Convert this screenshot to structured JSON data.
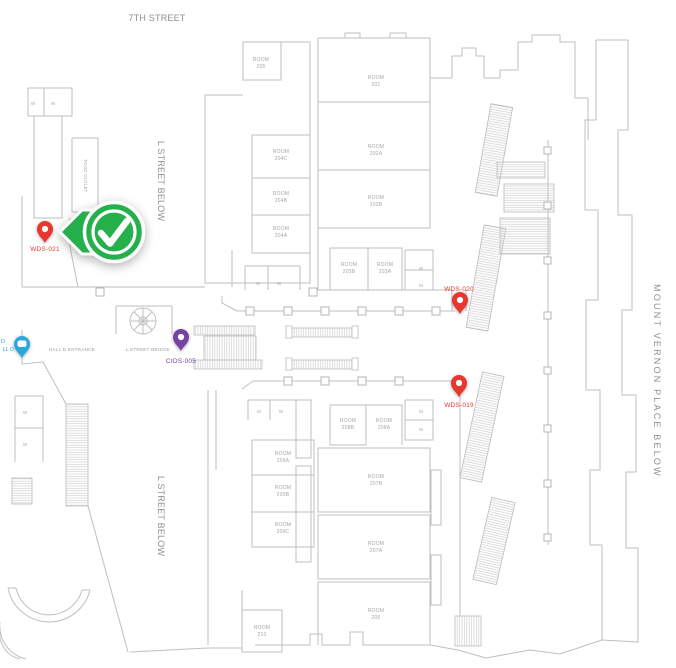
{
  "map": {
    "colors": {
      "red": "#e8372e",
      "purple": "#7544a3",
      "cyan": "#29a8e0",
      "green": "#25b04b",
      "wall": "#bfbfbf"
    },
    "streets": {
      "seventh": "7TH STREET",
      "l_street_upper": "L STREET BELOW",
      "l_street_lower": "L STREET BELOW",
      "mount_vernon": "MOUNT VERNON PLACE BELOW"
    },
    "areas": {
      "hall_d_entrance": "HALL D ENTRANCE",
      "l_street_bridge": "L STREET BRIDGE",
      "food_outlet": "FOOD OUTLET"
    },
    "legend": {
      "w": "W",
      "m": "M"
    },
    "room_word": "ROOM",
    "rooms": [
      {
        "number": "205"
      },
      {
        "number": "201"
      },
      {
        "number": "204C"
      },
      {
        "number": "202A"
      },
      {
        "number": "204B"
      },
      {
        "number": "202B"
      },
      {
        "number": "204A"
      },
      {
        "number": "203B"
      },
      {
        "number": "203A"
      },
      {
        "number": "208B"
      },
      {
        "number": "208A"
      },
      {
        "number": "209A"
      },
      {
        "number": "209B"
      },
      {
        "number": "209C"
      },
      {
        "number": "207B"
      },
      {
        "number": "207A"
      },
      {
        "number": "206"
      },
      {
        "number": "210"
      }
    ],
    "pins": {
      "wds021": {
        "label": "WDS-021",
        "color": "#e8372e"
      },
      "wds020": {
        "label": "WDS-020",
        "color": "#e8372e"
      },
      "wds019": {
        "label": "WDS-019",
        "color": "#e8372e"
      },
      "cids005": {
        "label": "CIDS-005",
        "color": "#7544a3"
      },
      "hall_d": {
        "fragment_top": "D",
        "fragment_bottom": "LL D",
        "color": "#29a8e0"
      }
    }
  }
}
